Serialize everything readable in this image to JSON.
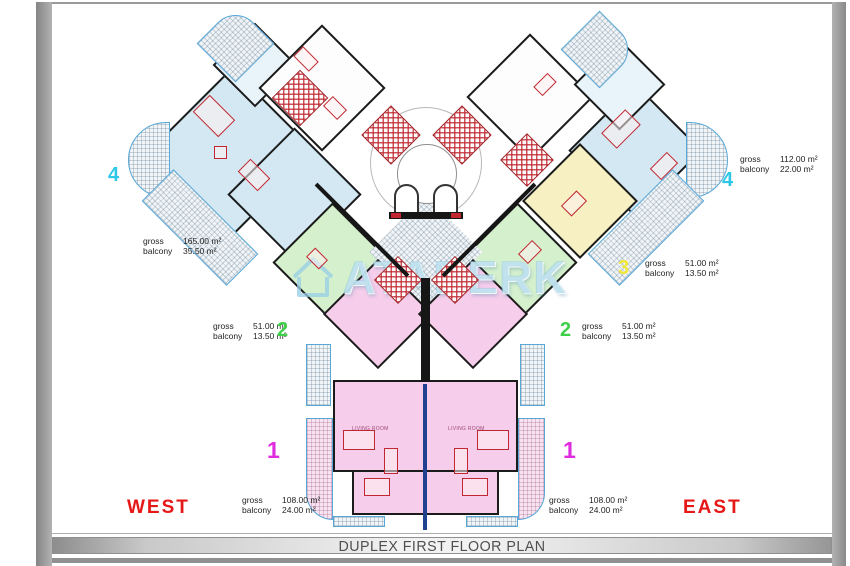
{
  "plan": {
    "sheet_title": "DUPLEX FIRST FLOOR PLAN",
    "watermark_text": "ATABERK",
    "watermark_icon": "house-outline-icon",
    "directions": {
      "west": "WEST",
      "east": "EAST"
    },
    "area_labels": {
      "gross": "gross",
      "balcony": "balcony"
    },
    "room_labels": {
      "living_room": "LIVING ROOM"
    },
    "units": [
      {
        "id": "4-west",
        "number": "4",
        "number_color": "#2dc7e8",
        "gross": "165.00 m²",
        "balcony": "35.50 m²"
      },
      {
        "id": "4-east",
        "number": "4",
        "number_color": "#2dc7e8",
        "gross": "112.00 m²",
        "balcony": "22.00 m²"
      },
      {
        "id": "3-east",
        "number": "3",
        "number_color": "#f0e838",
        "gross": "51.00 m²",
        "balcony": "13.50 m²"
      },
      {
        "id": "2-east",
        "number": "2",
        "number_color": "#3ed048",
        "gross": "51.00 m²",
        "balcony": "13.50 m²"
      },
      {
        "id": "2-west",
        "number": "2",
        "number_color": "#3ed048",
        "gross": "51.00 m²",
        "balcony": "13.50 m²"
      },
      {
        "id": "1-west",
        "number": "1",
        "number_color": "#e02ce0",
        "gross": "108.00 m²",
        "balcony": "24.00 m²"
      },
      {
        "id": "1-east",
        "number": "1",
        "number_color": "#e02ce0",
        "gross": "108.00 m²",
        "balcony": "24.00 m²"
      }
    ],
    "palette": {
      "unit_4_fill": "#d3e8f2",
      "unit_3_fill": "#f6f0c2",
      "unit_2_fill": "#d5f0cd",
      "unit_1_fill": "#f6cdeb",
      "balcony_outline": "#57a7d7",
      "wall": "#1b1b1b",
      "furniture_red": "#c02730",
      "axis_line_navy": "#20418f",
      "direction_red": "#e61717",
      "frame_gray": "#9a9a9a"
    }
  }
}
